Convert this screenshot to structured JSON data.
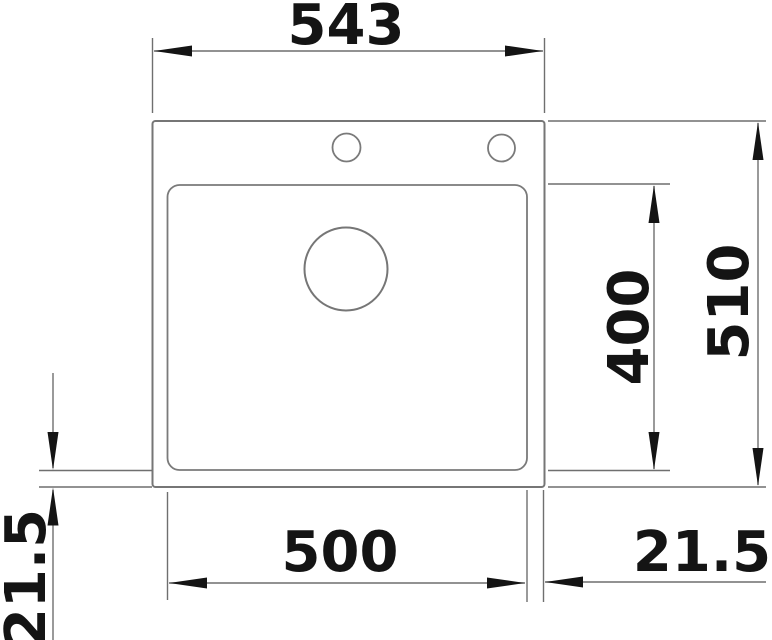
{
  "dims": {
    "overall_width": "543",
    "overall_depth": "510",
    "basin_width": "500",
    "basin_depth": "400",
    "rim_bottom": "21.5",
    "rim_right": "21.5"
  },
  "colors": {
    "background": "#ffffff",
    "outline": "#767676",
    "dimension_line": "#6f6f6f",
    "text_and_arrows": "#141414"
  }
}
